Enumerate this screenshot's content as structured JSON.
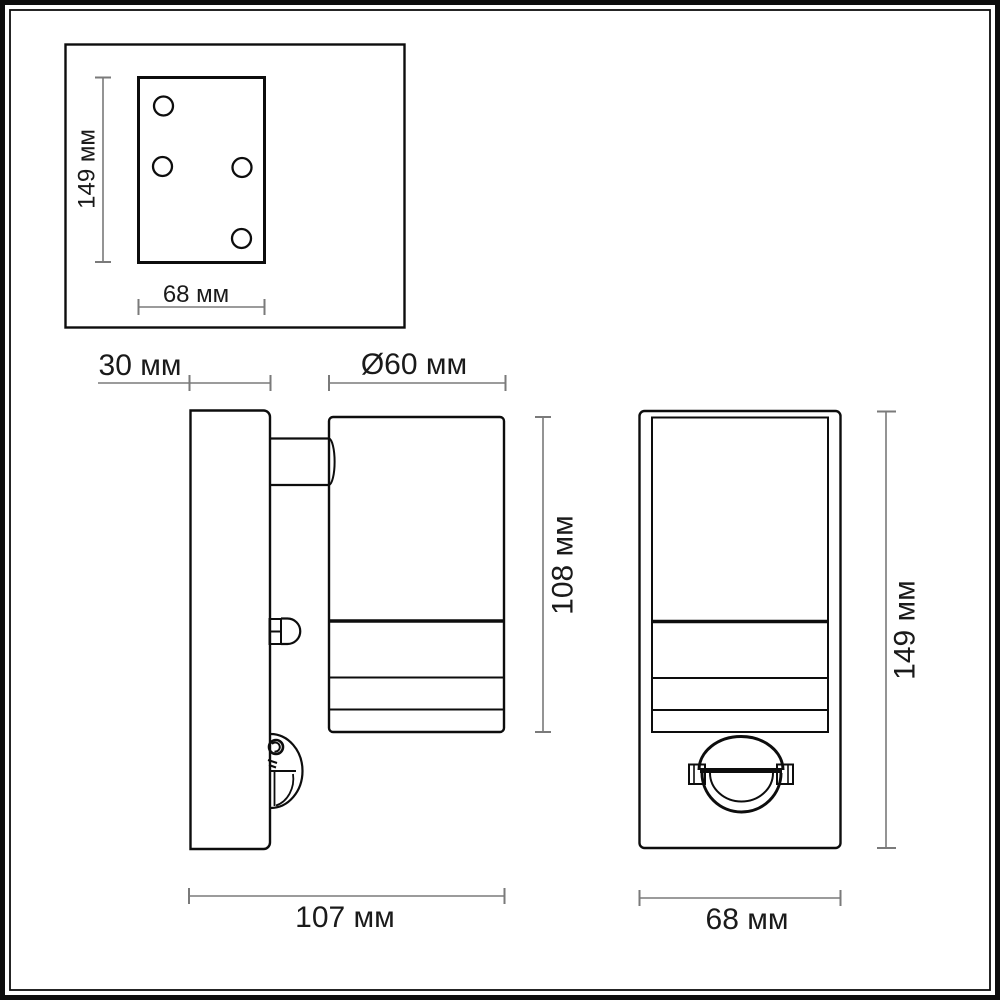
{
  "drawing": {
    "type": "technical-dimension-drawing",
    "subject": "wall lamp with motion sensor",
    "unit": "мм",
    "colors": {
      "outline": "#0d0d0d",
      "dimension_line": "#7a7a7a",
      "label_text": "#1a1a1a",
      "background": "#ffffff"
    },
    "mounting_plate_view": {
      "height_label": "149 мм",
      "width_label": "68 мм",
      "hole_count": 4
    },
    "side_view": {
      "plate_depth_label": "30 мм",
      "diameter_label": "Ø60 мм",
      "body_height_label": "108 мм",
      "total_depth_label": "107 мм"
    },
    "front_view": {
      "height_label": "149 мм",
      "width_label": "68 мм"
    }
  }
}
